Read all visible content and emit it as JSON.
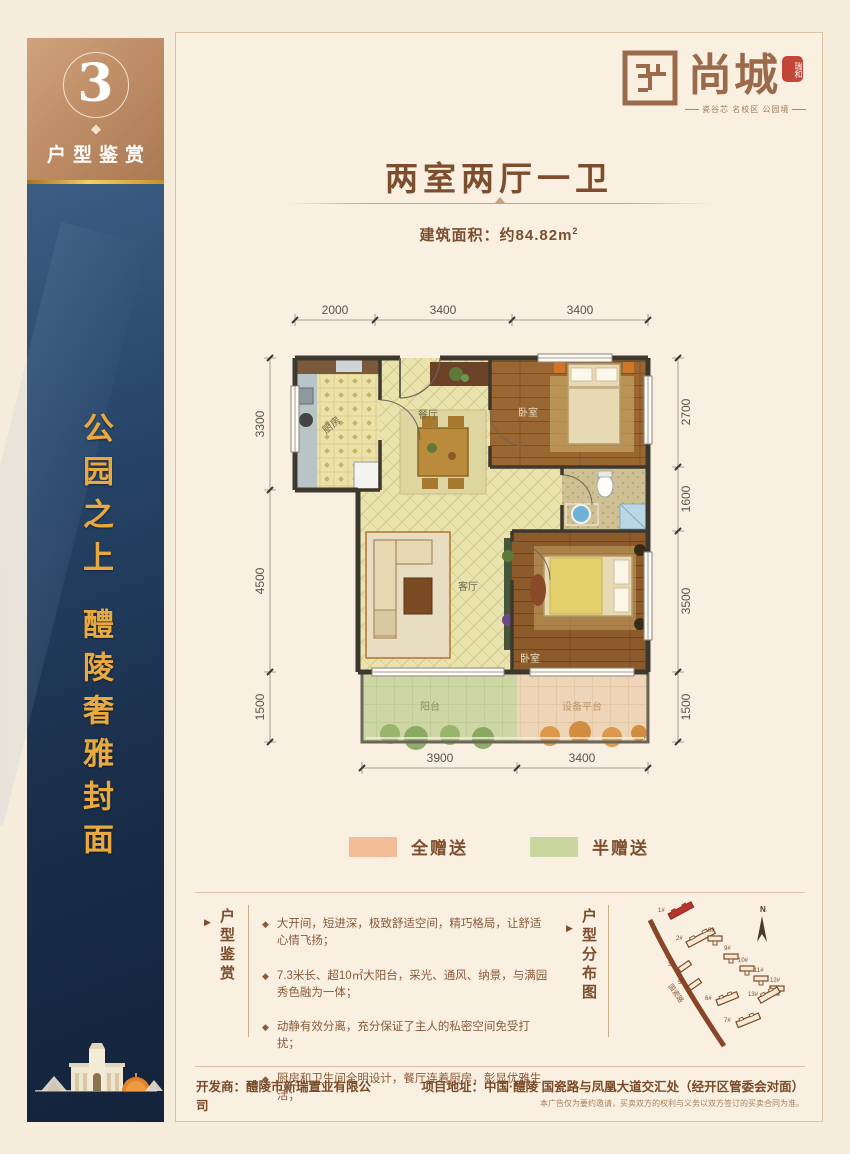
{
  "page": {
    "bg": "#f6ecdb",
    "accent_brown": "#7d4e2d",
    "accent_gold": "#e9a93e",
    "navy": "#1a2f4b"
  },
  "ui": {
    "bullet": "◆",
    "arrow": "▶"
  },
  "sidebar": {
    "number": "3",
    "label": "户型鉴赏",
    "slogan_line1": "公园之上",
    "slogan_line2": "醴陵奢雅封面"
  },
  "logo": {
    "name": "尚城",
    "seal": "瑞和",
    "tagline": "瓷谷芯 名校区 公园境"
  },
  "header": {
    "title": "两室两厅一卫",
    "area_label": "建筑面积：约84.82m",
    "area_sup": "2"
  },
  "plan": {
    "dims_top": [
      "2000",
      "3400",
      "3400"
    ],
    "dims_left": [
      "3300",
      "4500",
      "1500"
    ],
    "dims_right": [
      "2700",
      "1600",
      "3500",
      "1500"
    ],
    "dims_bottom": [
      "3900",
      "3400"
    ],
    "rooms": {
      "kitchen": "厨房",
      "dining": "餐厅",
      "bedroom1": "卧室",
      "living": "客厅",
      "bedroom2": "卧室",
      "balcony": "阳台",
      "equipment": "设备平台"
    }
  },
  "legend": [
    {
      "label": "全赠送",
      "color": "#f3bd98"
    },
    {
      "label": "半赠送",
      "color": "#c9d69d"
    }
  ],
  "features": {
    "label": "户型鉴赏",
    "items": [
      "大开间，短进深，极致舒适空间，精巧格局，让舒适心情飞扬；",
      "7.3米长、超10㎡大阳台，采光、通风、纳景，与满园秀色融为一体；",
      "动静有效分离，充分保证了主人的私密空间免受打扰；",
      "厨房和卫生间全明设计，餐厅连着厨房，彰显优雅生活；"
    ]
  },
  "sitemap": {
    "label": "户型分布图",
    "road": "国瓷路",
    "compass": "N",
    "buildings": [
      "1#",
      "2#",
      "3#",
      "5#",
      "6#",
      "7#",
      "8#",
      "9#",
      "10#",
      "11#",
      "12#",
      "13#"
    ]
  },
  "footer": {
    "developer": "开发商：醴陵市新瑞置业有限公司",
    "address": "项目地址：中国·醴陵 国瓷路与凤凰大道交汇处（经开区管委会对面）",
    "disclaimer": "本广告仅为要约邀请，买卖双方的权利与义务以双方签订的买卖合同为准。"
  }
}
